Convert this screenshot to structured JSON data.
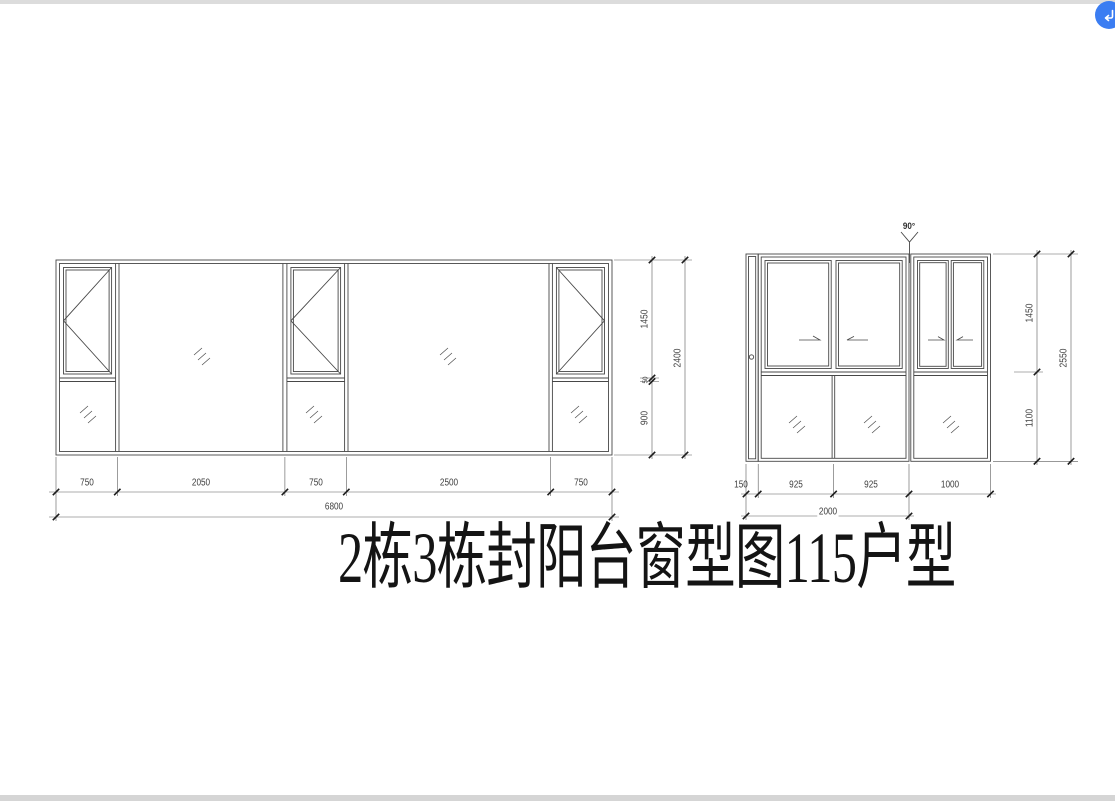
{
  "drawing": {
    "title": "2栋3栋封阳台窗型图115户型",
    "left_elevation": {
      "bottom_dims": [
        "750",
        "2050",
        "750",
        "2500",
        "750"
      ],
      "bottom_total": "6800",
      "side_dims": [
        "1450",
        "50",
        "900"
      ],
      "side_total": "2400"
    },
    "right_elevation": {
      "angle_label": "90°",
      "bottom_dims": [
        "150",
        "925",
        "925",
        "1000"
      ],
      "bottom_total": "2000",
      "side_dims": [
        "1450",
        "1100"
      ],
      "side_total": "2550"
    }
  },
  "viewer": {
    "fab_icon": "return-arrow-icon",
    "fab_color": "#3b7df2"
  },
  "colors": {
    "line": "#474747",
    "dim_line": "#5a5a5a",
    "tick": "#1c1c1c",
    "dim_text": "#3e3e3e",
    "page_edge": "#d5d5d5"
  }
}
